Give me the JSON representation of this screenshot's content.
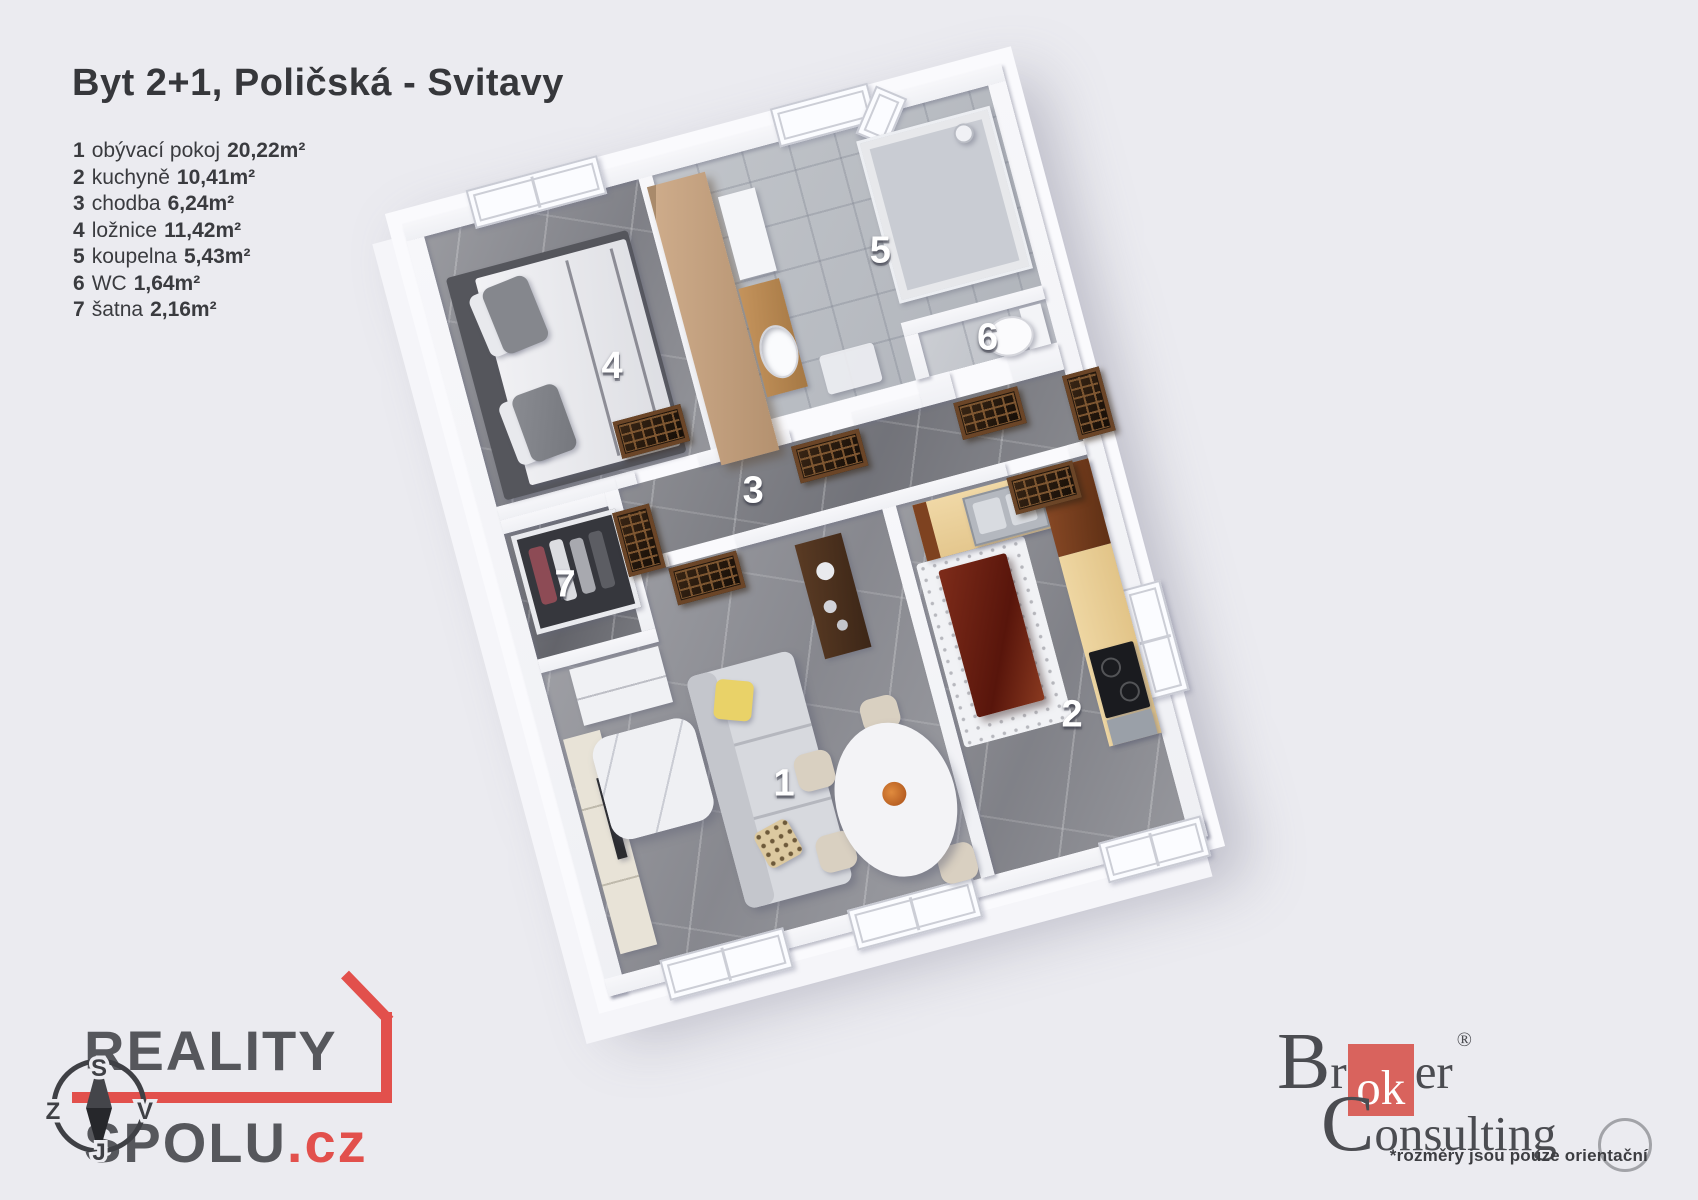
{
  "title": "Byt 2+1, Poličská - Svitavy",
  "legend": [
    {
      "num": "1",
      "name": "obývací pokoj",
      "area": "20,22m²"
    },
    {
      "num": "2",
      "name": "kuchyně",
      "area": "10,41m²"
    },
    {
      "num": "3",
      "name": "chodba",
      "area": "6,24m²"
    },
    {
      "num": "4",
      "name": "ložnice",
      "area": "11,42m²"
    },
    {
      "num": "5",
      "name": "koupelna",
      "area": "5,43m²"
    },
    {
      "num": "6",
      "name": "WC",
      "area": "1,64m²"
    },
    {
      "num": "7",
      "name": "šatna",
      "area": "2,16m²"
    }
  ],
  "plan": {
    "rooms": {
      "living": "1",
      "kitchen": "2",
      "hall": "3",
      "bedroom": "4",
      "bathroom": "5",
      "wc": "6",
      "closet": "7"
    }
  },
  "branding": {
    "reality_spolu": {
      "word1": "REALITY",
      "word2": "SPOLU",
      "tld": ".cz"
    },
    "broker": {
      "b": "B",
      "r": "r",
      "ok": "ok",
      "er": "er",
      "reg": "®",
      "c": "C",
      "onsulting": "onsulting",
      "footnote": "*rozměry jsou pouze orientační"
    }
  },
  "compass": {
    "n": "S",
    "e": "V",
    "s": "J",
    "w": "Z"
  },
  "colors": {
    "background": "#ebebf0",
    "accent_red": "#e2504c",
    "broker_red": "#d9635d",
    "logo_gray": "#56575c",
    "text_dark": "#36373b"
  }
}
